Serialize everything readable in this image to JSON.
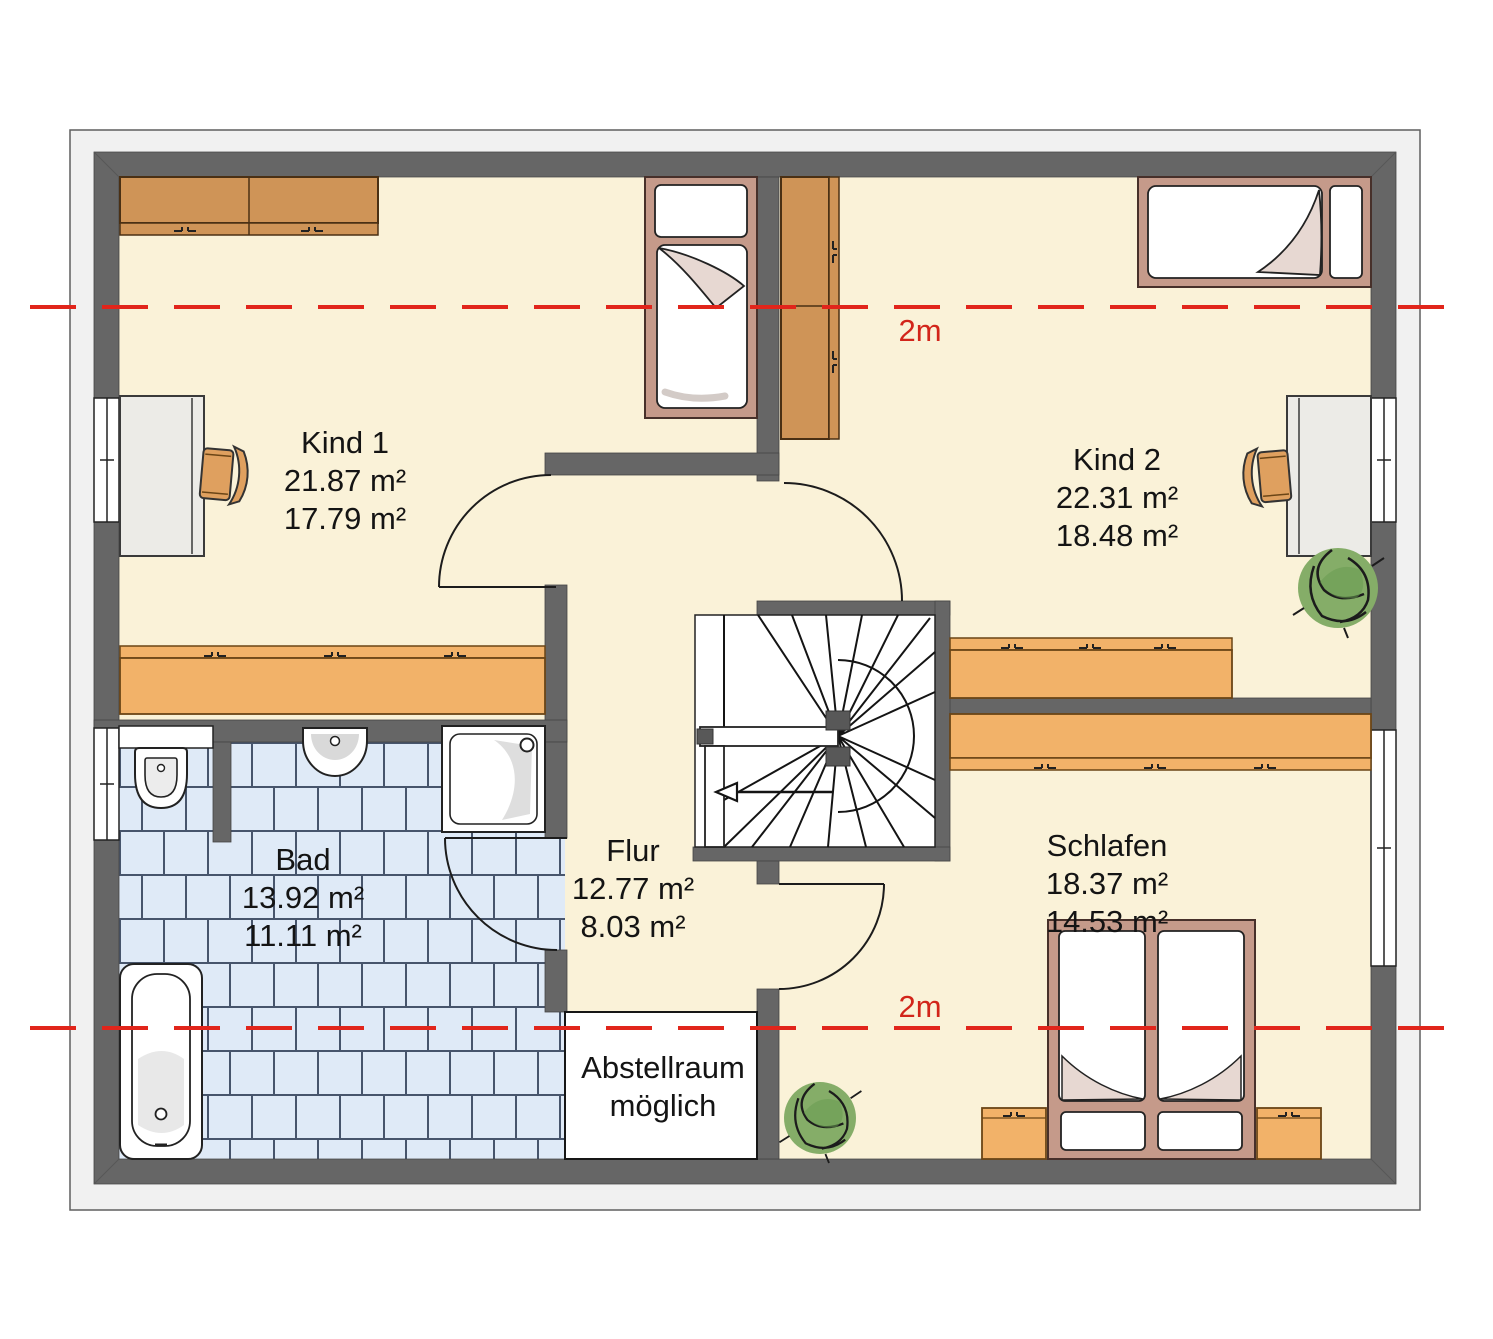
{
  "title": "Obergeschoss Grundriss",
  "rooms": [
    {
      "id": "kind1",
      "name": "Kind 1",
      "area1": "21.87 m²",
      "area2": "17.79 m²"
    },
    {
      "id": "kind2",
      "name": "Kind 2",
      "area1": "22.31 m²",
      "area2": "18.48 m²"
    },
    {
      "id": "bad",
      "name": "Bad",
      "area1": "13.92 m²",
      "area2": "11.11 m²"
    },
    {
      "id": "flur",
      "name": "Flur",
      "area1": "12.77 m²",
      "area2": "8.03 m²"
    },
    {
      "id": "schlafen",
      "name": "Schlafen",
      "area1": "18.37 m²",
      "area2": "14.53 m²"
    }
  ],
  "annotations": {
    "storage_line1": "Abstellraum",
    "storage_line2": "möglich",
    "headroom_top": "2m",
    "headroom_bottom": "2m"
  },
  "colors": {
    "headroom_line": "#e1251b",
    "wall": "#666666",
    "floor": "#faf2d8",
    "bath_tile": "#dfeaf7",
    "furniture_wood": "#f2b269",
    "furniture_dark_wood": "#cf9457",
    "bed_frame": "#c59a8a"
  }
}
